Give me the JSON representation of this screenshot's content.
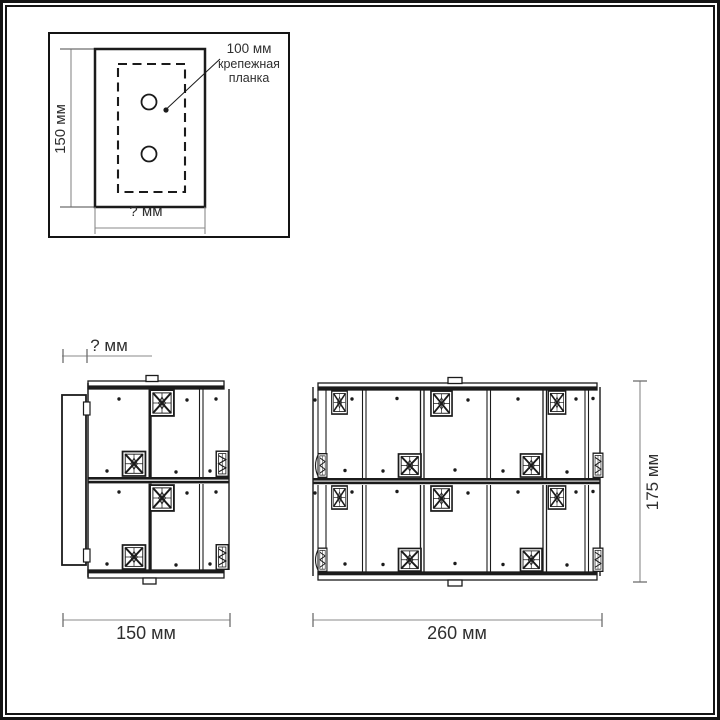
{
  "colors": {
    "line": "#1b1b1b",
    "dimension_line": "#8a8a8a",
    "text": "#2f2f2f",
    "background": "#ffffff"
  },
  "mounting_plate_inset": {
    "height_label": "150 мм",
    "width_label": "? мм",
    "hole_spacing_label": "100 мм",
    "plate_label_line1": "крепежная",
    "plate_label_line2": "планка"
  },
  "side_view": {
    "depth_label": "? мм",
    "width_label": "150 мм"
  },
  "front_view": {
    "width_label": "260 мм",
    "height_label": "175 мм"
  }
}
